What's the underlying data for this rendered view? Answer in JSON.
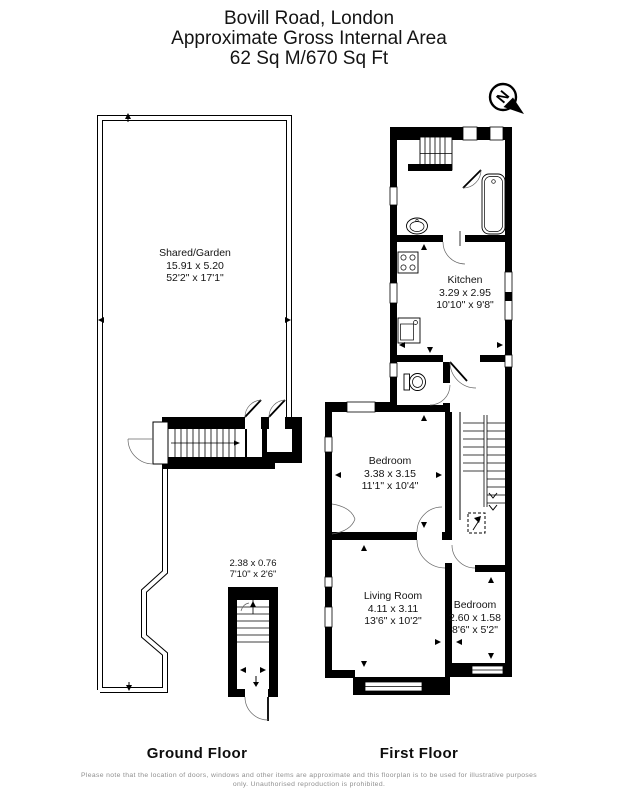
{
  "header": {
    "title": "Bovill Road, London",
    "subtitle": "Approximate Gross Internal Area",
    "area": "62 Sq M/670 Sq Ft"
  },
  "compass": {
    "label": "N"
  },
  "ground_floor": {
    "caption": "Ground Floor",
    "garden": {
      "name": "Shared/Garden",
      "metric": "15.91 x 5.20",
      "imperial": "52'2\" x 17'1\""
    },
    "entrance": {
      "metric": "2.38 x 0.76",
      "imperial": "7'10\" x 2'6\""
    }
  },
  "first_floor": {
    "caption": "First Floor",
    "kitchen": {
      "name": "Kitchen",
      "metric": "3.29 x 2.95",
      "imperial": "10'10\" x 9'8\""
    },
    "bedroom1": {
      "name": "Bedroom",
      "metric": "3.38 x 3.15",
      "imperial": "11'1\" x 10'4\""
    },
    "living_room": {
      "name": "Living Room",
      "metric": "4.11 x 3.11",
      "imperial": "13'6\" x 10'2\""
    },
    "bedroom2": {
      "name": "Bedroom",
      "metric": "2.60 x 1.58",
      "imperial": "8'6\" x 5'2\""
    }
  },
  "footer": {
    "disclaimer": "Please note that the location of doors, windows and other items are approximate and this floorplan is to be used for illustrative purposes only. Unauthorised reproduction is prohibited."
  },
  "colors": {
    "wall": "#000000",
    "text": "#141414",
    "disclaimer": "#8f8f8f"
  }
}
